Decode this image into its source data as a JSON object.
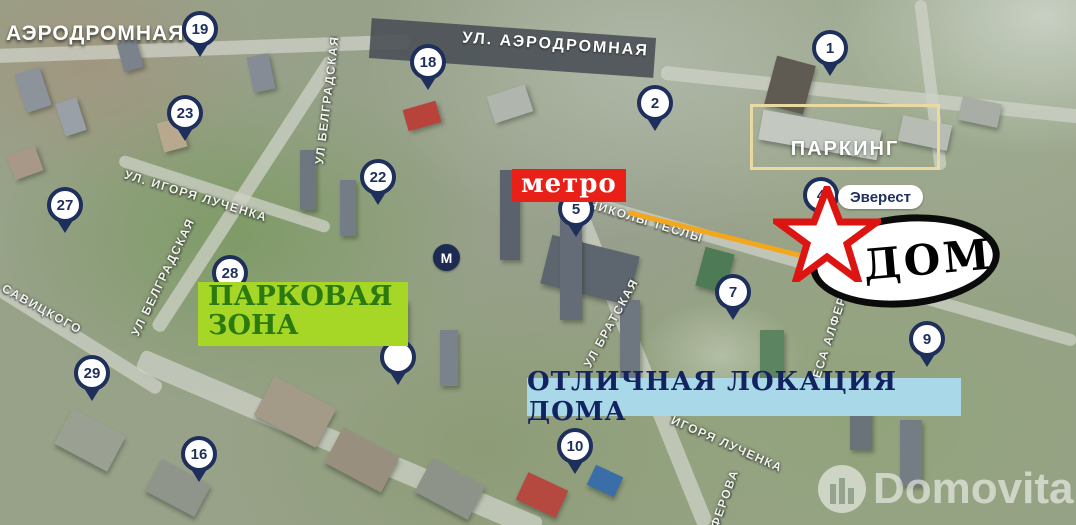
{
  "map": {
    "district_label": "АЭРОДРОМНАЯ",
    "overpass_label": "УЛ. АЭРОДРОМНАЯ",
    "street_labels": [
      {
        "text": "УЛ БЕЛГРАДСКАЯ"
      },
      {
        "text": "УЛ. ИГОРЯ ЛУЧЕНКА"
      },
      {
        "text": "УЛ БЕЛГРАДСКАЯ"
      },
      {
        "text": "САВИЦКОГО"
      },
      {
        "text": "НИКОЛЫ ТЕСЛЫ"
      },
      {
        "text": "УЛ БРАТСКАЯ"
      },
      {
        "text": "ЖОРЕСА АЛФЕРОВА"
      },
      {
        "text": "ИГОРЯ ЛУЧЕНКА"
      },
      {
        "text": "АЛФЕРОВА"
      }
    ],
    "pins": [
      {
        "label": "19"
      },
      {
        "label": "23"
      },
      {
        "label": "18"
      },
      {
        "label": "2"
      },
      {
        "label": "1"
      },
      {
        "label": "22"
      },
      {
        "label": "5"
      },
      {
        "label": "27"
      },
      {
        "label": "4"
      },
      {
        "label": "28"
      },
      {
        "label": "7"
      },
      {
        "label": "29"
      },
      {
        "label": "9"
      },
      {
        "label": ""
      },
      {
        "label": "16"
      },
      {
        "label": "10"
      }
    ],
    "metro_sign": "метро",
    "metro_station_icon": "М",
    "parking_label": "ПАРКИНГ",
    "everest_label": "Эверест",
    "house_label": "ДОМ",
    "park_zone": {
      "line1": "ПАРКОВАЯ",
      "line2": "ЗОНА"
    },
    "location_banner": "ОТЛИЧНАЯ ЛОКАЦИЯ ДОМА",
    "watermark": "Domovita",
    "colors": {
      "pin_navy": "#1e2f5c",
      "metro_red": "#e82017",
      "park_green_bg": "#a6d626",
      "park_green_text": "#2a7a10",
      "location_bg": "#a9d9e8",
      "location_text": "#13235f",
      "parking_border": "#ead9a0",
      "star_red": "#dd1512",
      "accent_line_orange": "#f2a71f"
    }
  }
}
